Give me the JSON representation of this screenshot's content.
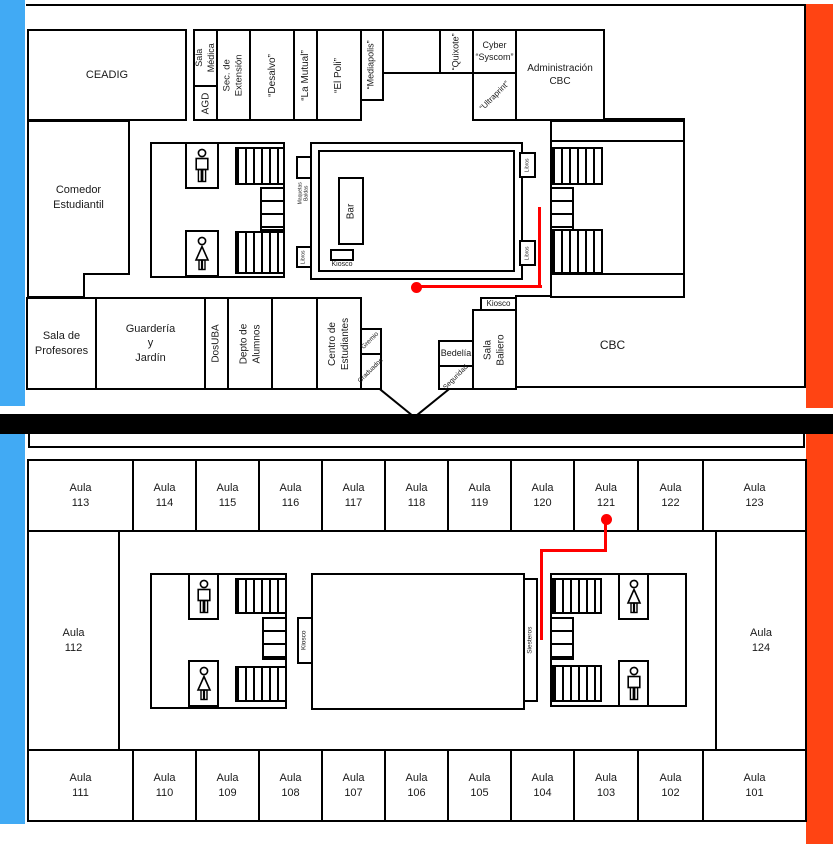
{
  "title": "Mapa del edificio - plantas con aulas y locales",
  "colors": {
    "corridor_blue": "#41AAF4",
    "corridor_orange": "#FF4413",
    "route_red": "#FF0000",
    "wall_black": "#000000"
  },
  "upper": {
    "ceadig": "CEADIG",
    "sala_medica": "Sala\nMédica",
    "agd": "AGD",
    "sec_extension": "Sec. de\nExtensión",
    "desalvo": "“Desalvo”",
    "la_mutual": "“La Mutual”",
    "el_poli": "“El Poli”",
    "mediapolis": "“Mediapolis”",
    "quixote": "“Quixote”",
    "cyber_syscom": "Cyber\n“Syscom”",
    "ultraprint": "“Ultraprint”",
    "administracion_cbc": "Administración\nCBC",
    "comedor": "Comedor\nEstudiantil",
    "bar": "Bar",
    "kiosco_patio": "Kiosco",
    "maquetas": "Maquetas\nBaldas",
    "libros_izq": "Libros",
    "libros_der_sup": "Libros",
    "libros_der_inf": "Libros",
    "sala_profesores": "Sala de\nProfesores",
    "guarderia": "Guardería\ny\nJardín",
    "dosuba": "DosUBA",
    "depto_alumnos": "Depto de\nAlumnos",
    "centro_estudiantes": "Centro de\nEstudiantes",
    "gremio": "Gremio",
    "graduados": "Graduados",
    "bedelia": "Bedelía",
    "seguridad": "Seguridad",
    "sala_baliero": "Sala\nBaliero",
    "kiosco_cbc": "Kiosco",
    "cbc": "CBC"
  },
  "lower": {
    "top_row": [
      "Aula\n113",
      "Aula\n114",
      "Aula\n115",
      "Aula\n116",
      "Aula\n117",
      "Aula\n118",
      "Aula\n119",
      "Aula\n120",
      "Aula\n121",
      "Aula\n122",
      "Aula\n123"
    ],
    "aula_112": "Aula\n112",
    "aula_124": "Aula\n124",
    "bottom_row": [
      "Aula\n111",
      "Aula\n110",
      "Aula\n109",
      "Aula\n108",
      "Aula\n107",
      "Aula\n106",
      "Aula\n105",
      "Aula\n104",
      "Aula\n103",
      "Aula\n102",
      "Aula\n101"
    ],
    "kiosco": "Kiosco",
    "siesteros": "Siesteros"
  }
}
